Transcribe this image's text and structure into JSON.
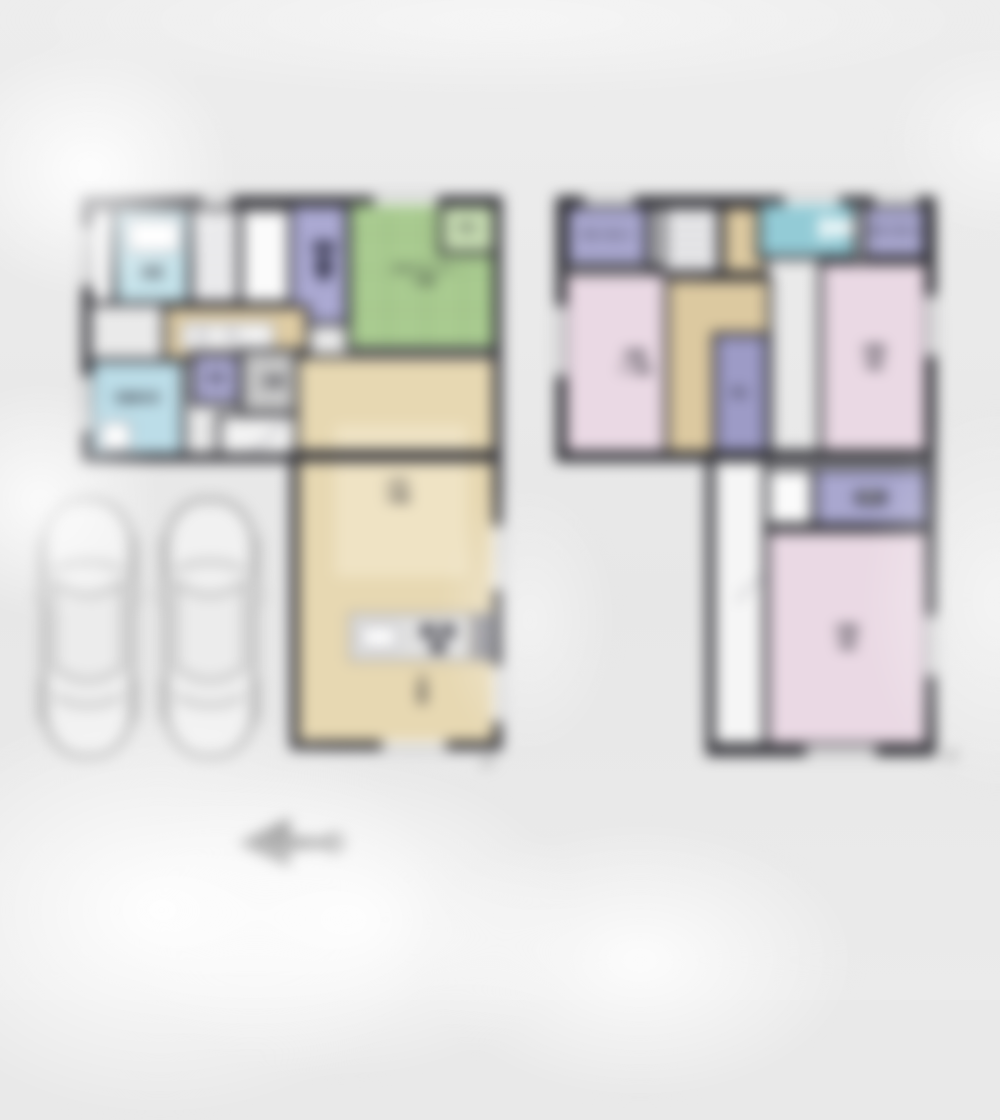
{
  "scene": {
    "type": "residential-floor-plan",
    "floors_shown": 2,
    "parking_spaces_drawn": 2
  },
  "colors": {
    "background": "#e9e9e9",
    "wall": "#2d2d33",
    "water_blue": "#bcdde8",
    "closet_purple": "#a9a7cf",
    "tatami_green": "#a9cb90",
    "wood_beige": "#e7d8b2",
    "hall_beige": "#dcc9a0",
    "bedroom_pink": "#ead9e4",
    "toilet_teal": "#93cbd6",
    "entrance_gray": "#c6c6c6"
  },
  "floor1": {
    "tag": "1F",
    "labels": {
      "bath": "浴室",
      "washroom": "洗面脱衣室",
      "storage": "収納",
      "entrance": "玄関",
      "tatami_name": "タタミコーナー",
      "tatami_size": "4.5帖",
      "oshiire": "押入",
      "ldk_name": "LDK",
      "ldk_size": "16帖",
      "fridge": "冷蔵庫"
    }
  },
  "floor2": {
    "tag": "2F",
    "labels": {
      "closet_tl": "クローゼット",
      "closet_tr": "クローゼット",
      "closet_center": "物入",
      "hall": "ホール",
      "wic": "WIC",
      "bed_left_name": "洋室",
      "bed_left_size": "7.75帖",
      "bed_right_name": "洋室",
      "bed_right_size": "6帖",
      "bed_bottom_name": "洋室",
      "bed_bottom_size": "6帖"
    }
  },
  "icons": {
    "north_arrow": "north-arrow-icon",
    "car": "car-icon",
    "toilet": "toilet-icon",
    "bathtub": "bathtub-icon",
    "washer": "washer-icon",
    "kitchen_sink": "sink-icon",
    "stove": "stove-icon",
    "stairs": "stairs-pattern"
  }
}
